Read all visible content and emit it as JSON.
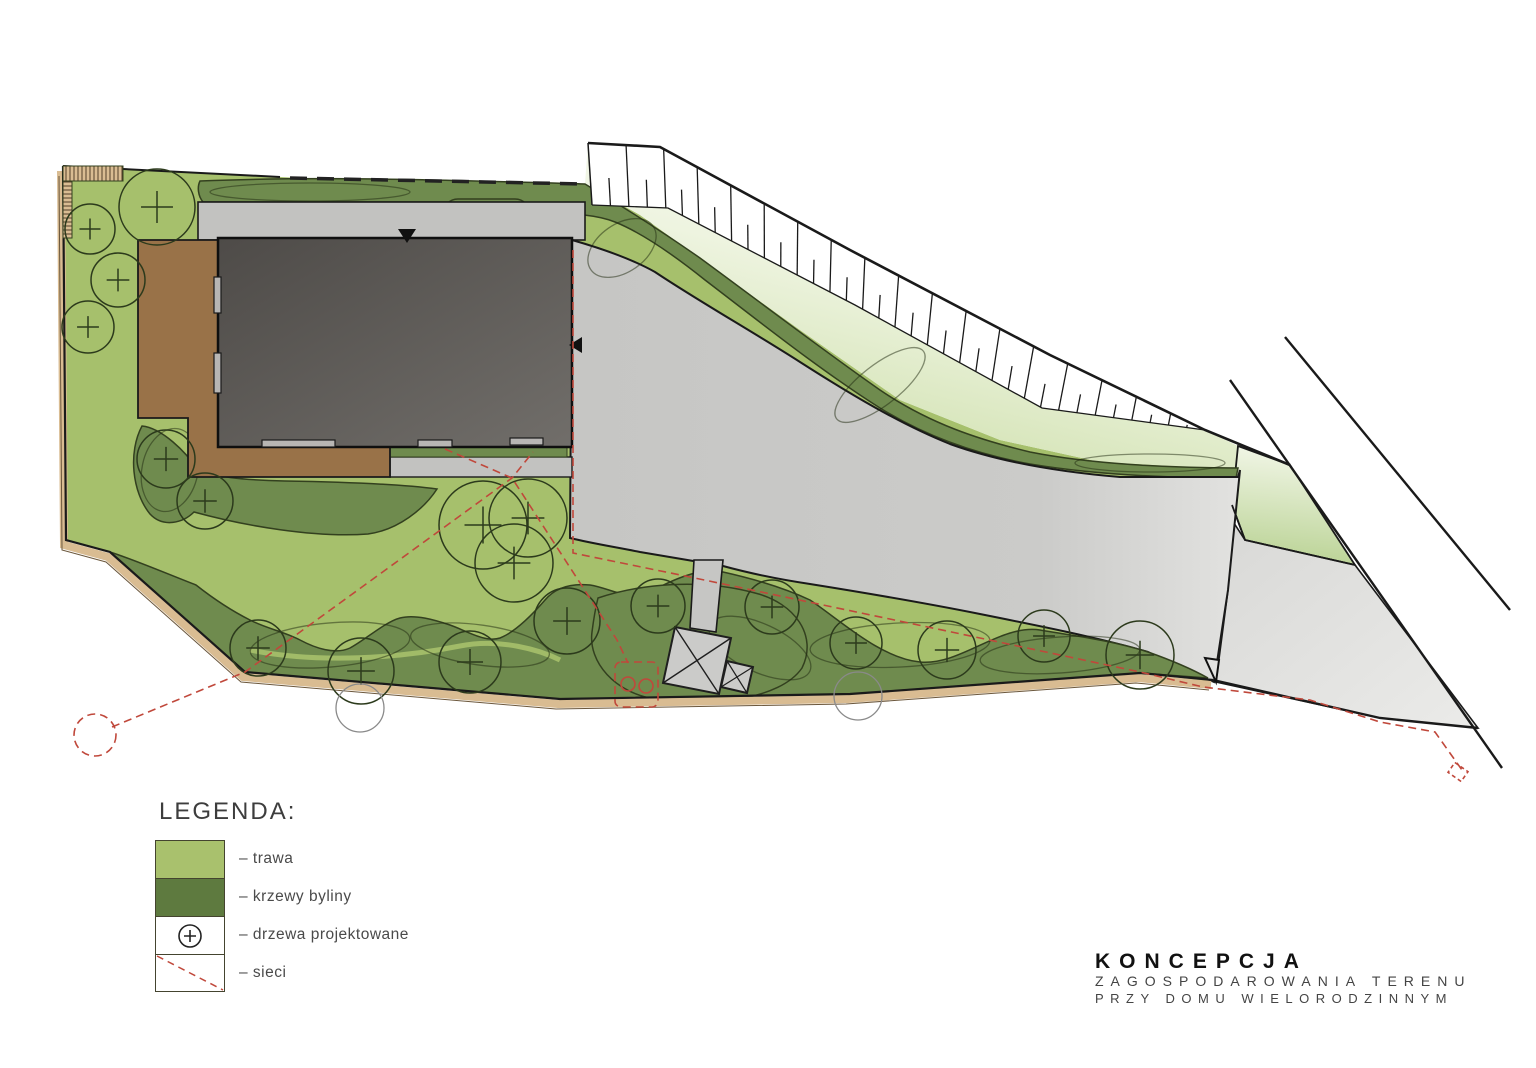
{
  "title_block": {
    "line1": "KONCEPCJA",
    "line2": "ZAGOSPODAROWANIA TERENU",
    "line3": "PRZY DOMU WIELORODZINNYM"
  },
  "legend": {
    "heading": "LEGENDA:",
    "items": [
      {
        "key": "grass",
        "label": "– trawa"
      },
      {
        "key": "shrubs",
        "label": "– krzewy byliny"
      },
      {
        "key": "trees",
        "label": "– drzewa projektowane"
      },
      {
        "key": "utilities",
        "label": "– sieci"
      }
    ]
  },
  "colors": {
    "grass": "#a6c06c",
    "slope_green": "#cadda5",
    "shrub": "#6f8b4e",
    "shrub_outline": "#33401f",
    "legend_grass": "#a9c16d",
    "legend_shrub": "#5e7a3f",
    "paving": "#c6c6c4",
    "paving_light": "#e2e2e0",
    "roof_dark": "#4e4b48",
    "roof_light": "#716e6a",
    "terrace": "#997248",
    "edge_tan": "#d9bc92",
    "utility_red": "#c0483b",
    "ink": "#1a1a1a",
    "tree_outline": "#2c3a1c"
  },
  "plan": {
    "trees": [
      [
        90,
        229,
        25
      ],
      [
        118,
        280,
        27
      ],
      [
        88,
        327,
        26
      ],
      [
        157,
        207,
        38
      ],
      [
        166,
        459,
        29
      ],
      [
        205,
        501,
        28
      ],
      [
        483,
        525,
        44
      ],
      [
        528,
        518,
        39
      ],
      [
        514,
        563,
        39
      ],
      [
        258,
        648,
        28
      ],
      [
        361,
        671,
        33
      ],
      [
        470,
        662,
        31
      ],
      [
        567,
        621,
        33
      ],
      [
        658,
        606,
        27
      ],
      [
        772,
        607,
        27
      ],
      [
        856,
        643,
        26
      ],
      [
        947,
        650,
        29
      ],
      [
        1044,
        636,
        26
      ],
      [
        1140,
        655,
        34
      ]
    ],
    "outside_trees": [
      [
        360,
        708,
        24
      ],
      [
        858,
        696,
        24
      ]
    ],
    "parking": {
      "stall_count": 18
    }
  }
}
